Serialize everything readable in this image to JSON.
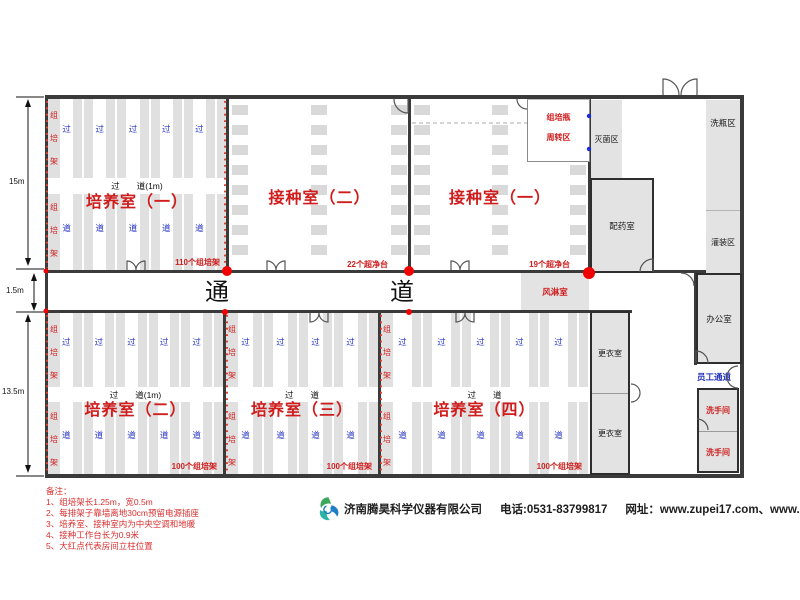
{
  "dims": {
    "top": "15m",
    "mid": "1.5m",
    "bottom": "13.5m"
  },
  "corridor": {
    "label_left": "通",
    "label_right": "道"
  },
  "labels": {
    "rack_col": "组培架",
    "aisle_top": "过",
    "aisle_bottom": "道",
    "aisle_center_1m": "过　　道(1m)",
    "aisle_center": "过　　道",
    "air_shower": "风淋室",
    "turnover_line1": "组培瓶",
    "turnover_line2": "周转区",
    "sterilization": "灭菌区",
    "pharmacy": "配药室",
    "bottle_wash": "洗瓶区",
    "filling": "灌装区",
    "office": "办公室",
    "staff_passage": "员工通道",
    "restroom": "洗手间",
    "changing_room": "更衣室"
  },
  "rooms": {
    "culture1": {
      "title": "培养室（一）",
      "count": "110个组培架"
    },
    "culture2": {
      "title": "培养室（二）",
      "count": "100个组培架"
    },
    "culture3": {
      "title": "培养室（三）",
      "count": "100个组培架"
    },
    "culture4": {
      "title": "培养室（四）",
      "count": "100个组培架"
    },
    "inoculation2": {
      "title": "接种室（二）",
      "count": "22个超净台"
    },
    "inoculation1": {
      "title": "接种室（一）",
      "count": "19个超净台"
    }
  },
  "notes": {
    "title": "备注：",
    "items": [
      "1、组培架长1.25m，宽0.5m",
      "2、每排架子靠墙离地30cm预留电源插座",
      "3、培养室、接种室内为中央空调和地暖",
      "4、接种工作台长为0.9米",
      "5、大红点代表房间立柱位置"
    ]
  },
  "footer": {
    "company": "济南腾昊科学仪器有限公司",
    "phone": "电话:0531-83799817",
    "website": "网址：www.zupei17.com、www.cnhtkj.com"
  },
  "colors": {
    "red": "#cf1d1d",
    "blue": "#2433c0",
    "gray_fill": "#e3e3e3",
    "wall": "#3a3a3a"
  }
}
